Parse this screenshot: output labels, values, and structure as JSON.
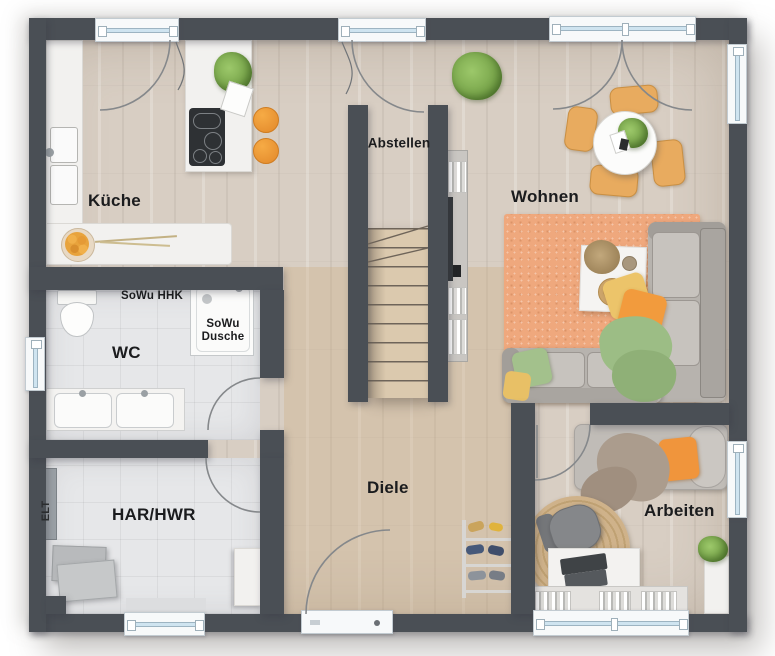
{
  "floor_plan": {
    "labels": {
      "kueche": "Küche",
      "sowu_hhk": "SoWu HHK",
      "sowu_dusche": "SoWu Dusche",
      "wc": "WC",
      "elt": "ELT",
      "har_hwr": "HAR/HWR",
      "abstellen": "Abstellen",
      "wohnen": "Wohnen",
      "diele": "Diele",
      "arbeiten": "Arbeiten"
    },
    "colors": {
      "wall": "#4a4f55",
      "wood_floor": "#d8cec3",
      "diele_floor": "#d2c0a6",
      "tile_floor": "#e6e7e9",
      "window_glass": "#cfe4f0",
      "accent_orange": "#f0953c",
      "rug_orange": "#efa87d",
      "sofa_gray": "#bcb8b3",
      "plant_green": "#7fae52",
      "stair_wood": "#dbc9ae"
    }
  }
}
